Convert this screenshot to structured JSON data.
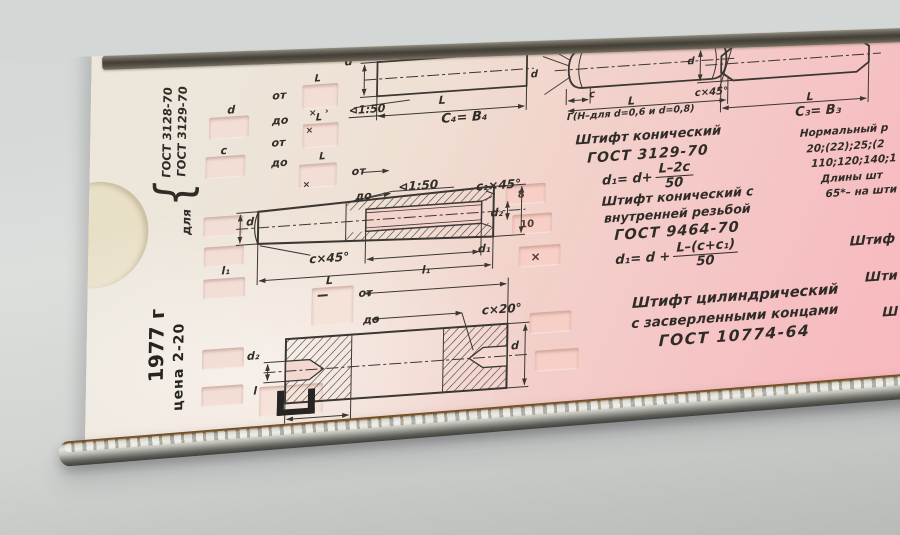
{
  "device": {
    "legend": {
      "prefix": "для",
      "brace": "{",
      "gost1": "ГОСТ 3128-70",
      "gost2": "ГОСТ 3129-70"
    },
    "footer": {
      "year": "1977 г",
      "price": "цена 2-20"
    },
    "dims": {
      "d": "d",
      "c": "c",
      "l": "l",
      "L": "L",
      "l1": "l₁",
      "d1": "d₁",
      "d2": "d₂",
      "cx45": "c×45°",
      "c1x45": "c₁×45°",
      "cx20": "c×20°",
      "taper": "⊲1:50",
      "ot": "от",
      "do": "до"
    },
    "top_row": {
      "c4b4": "C₄= B₄",
      "gamma_note": "Г(Н–для d=0,6 и d=0,8)",
      "c3b3": "C₃= B₃"
    },
    "captions": {
      "conical": {
        "title": "Штифт конический",
        "gost": "ГОСТ 3129-70",
        "formula": {
          "lhs": "d₁= d+",
          "num": "L–2c",
          "den": "50"
        }
      },
      "conical_threaded": {
        "title1": "Штифт конический с",
        "title2": "внутренней резьбой",
        "gost": "ГОСТ 9464-70",
        "formula": {
          "lhs": "d₁= d +",
          "num": "L–(c+c₁)",
          "den": "50"
        }
      },
      "cylindrical": {
        "title1": "Штифт цилиндрический",
        "title2": "с засверленными концами",
        "gost": "ГОСТ 10774-64"
      }
    },
    "right_column": {
      "l1": "Нормальный р",
      "l2": "20;(22);25;(2",
      "l3": "110;120;140;1",
      "l4": "Длины шт",
      "l5": "65*– на шти"
    },
    "right_edge": {
      "w1": "Штиф",
      "w2": "Шти",
      "w3": "Ш"
    },
    "windows": {
      "v1": "8",
      "v2": "10",
      "v3": "×",
      "m1": "×",
      "m2": "›",
      "m3": "×",
      "m4": "×"
    }
  }
}
